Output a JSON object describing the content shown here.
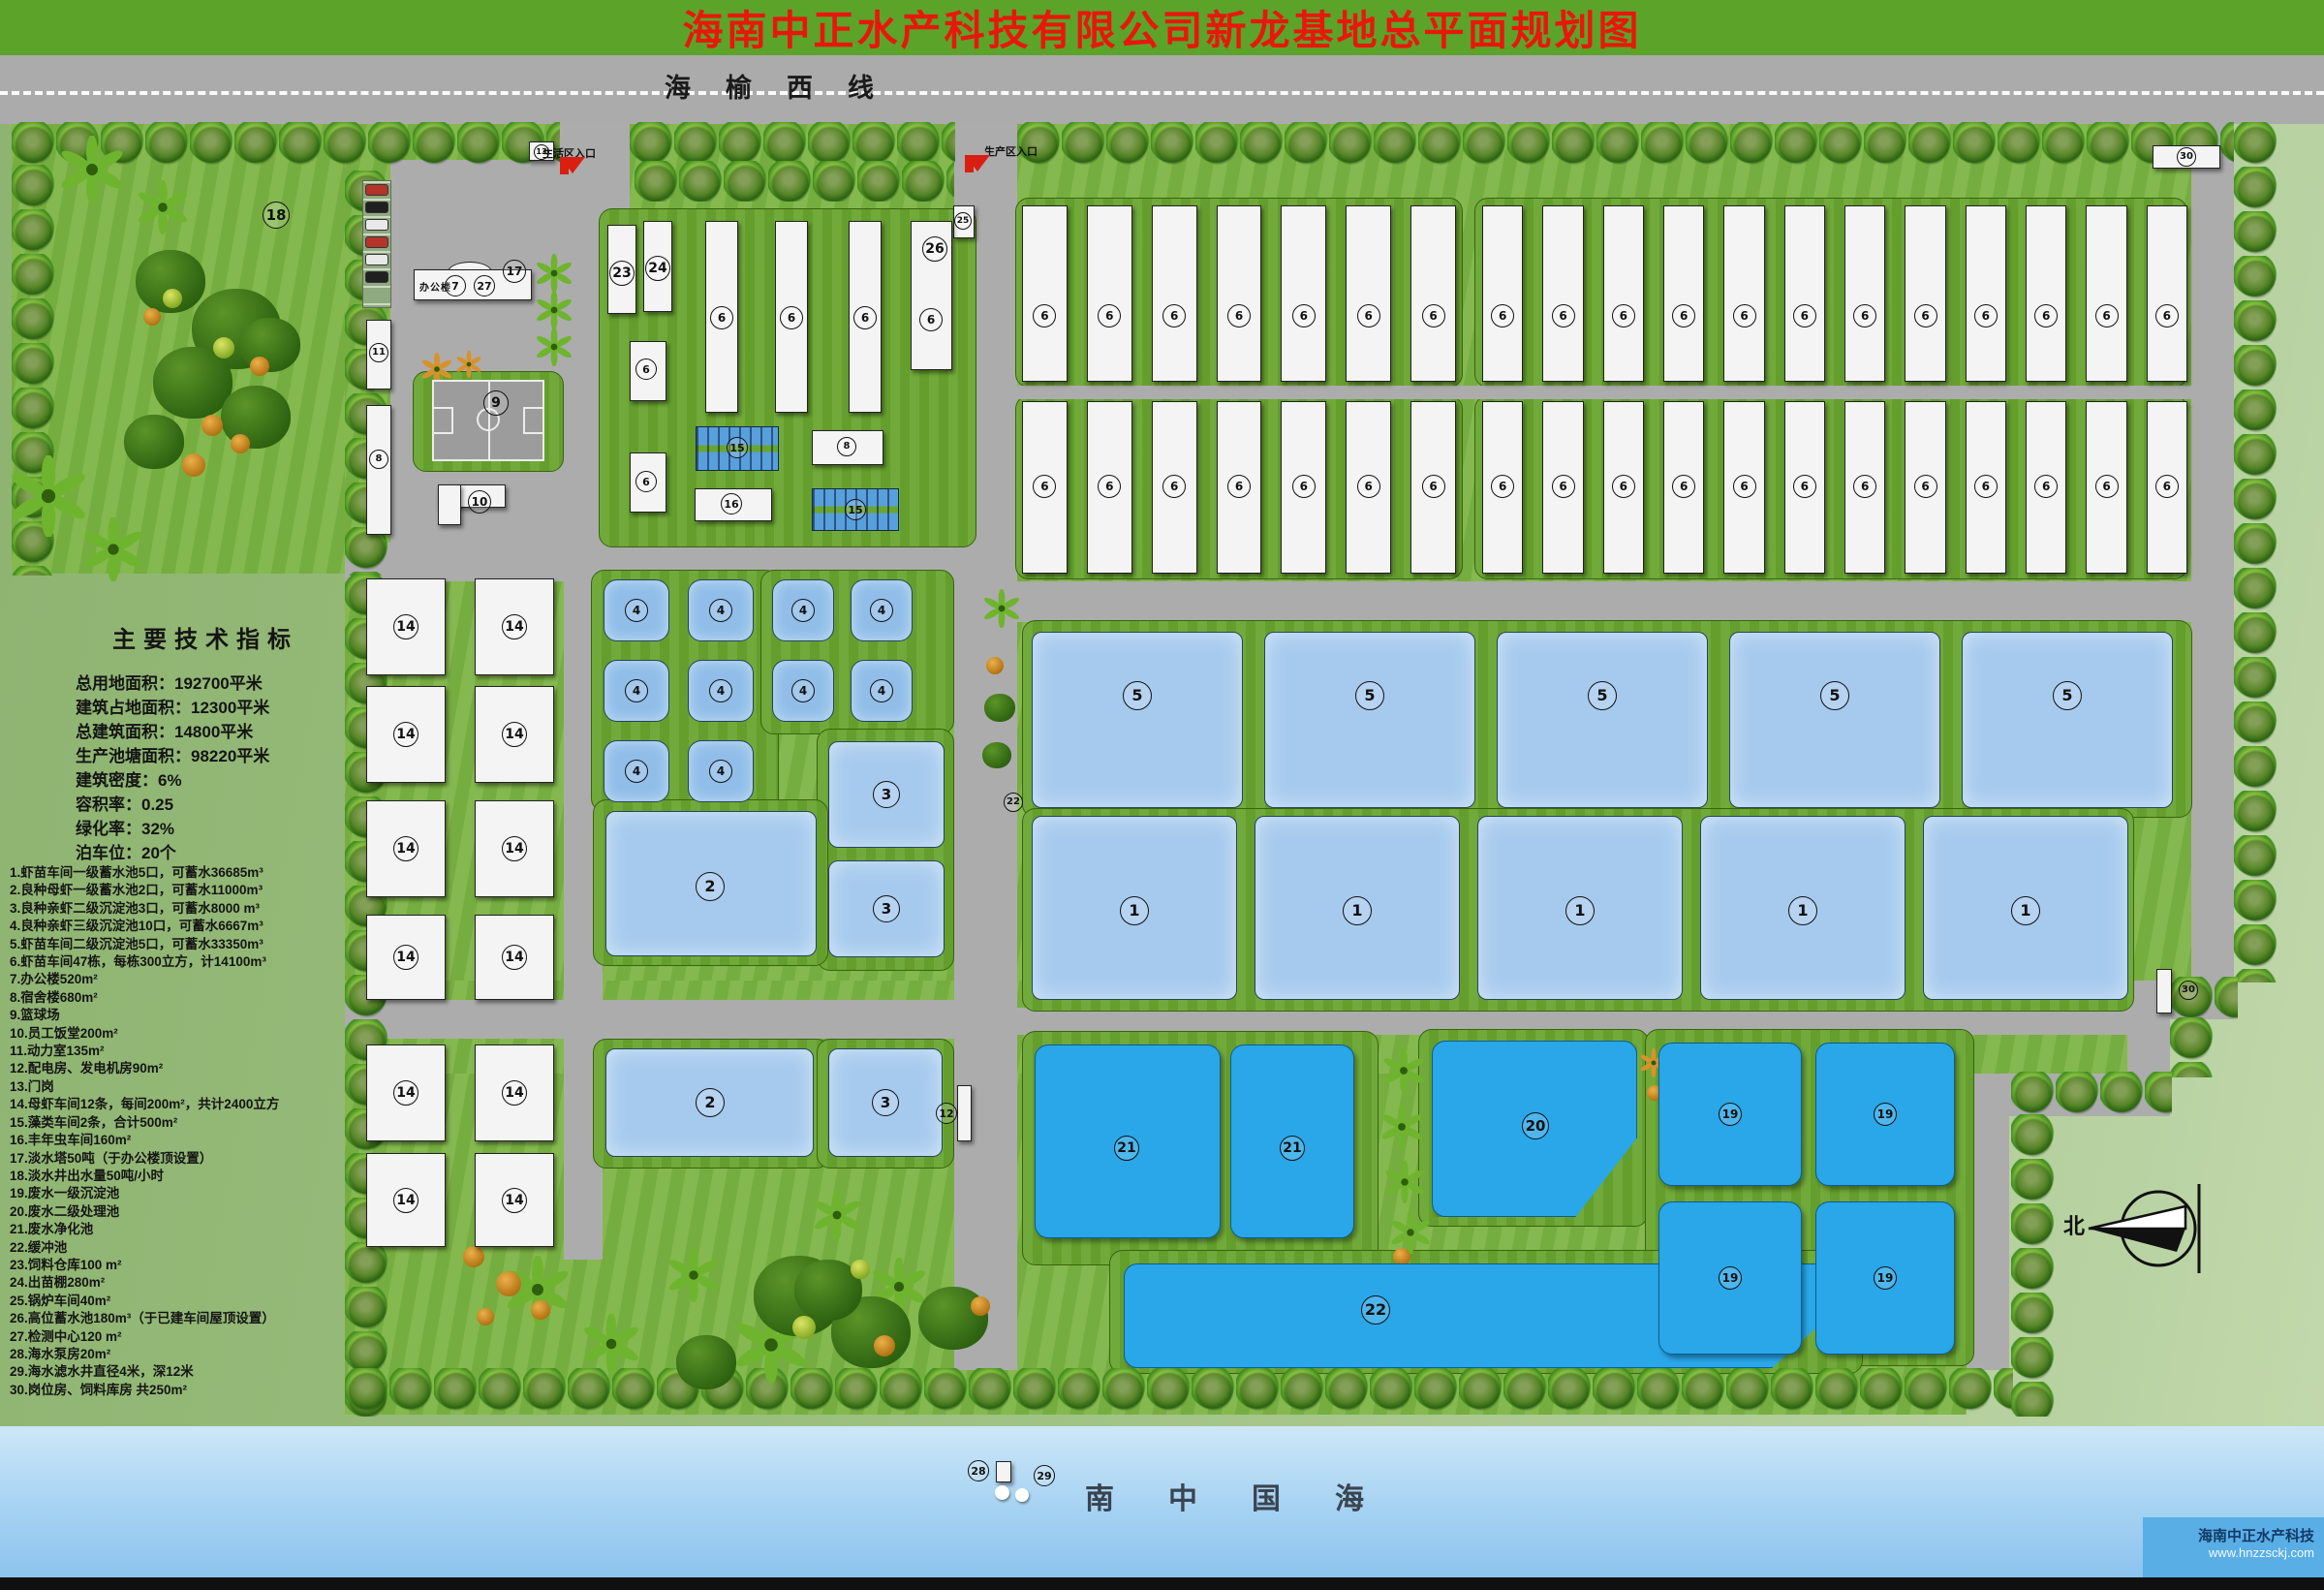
{
  "header": {
    "title": "海南中正水产科技有限公司新龙基地总平面规划图"
  },
  "highway": {
    "name": "海榆西线",
    "left_entrance": "生活区入口",
    "right_entrance": "生产区入口"
  },
  "indicators": {
    "title": "主要技术指标",
    "lines": [
      "总用地面积：192700平米",
      "建筑占地面积：12300平米",
      "总建筑面积：14800平米",
      "生产池塘面积：98220平米",
      "建筑密度：6%",
      "容积率：0.25",
      "绿化率：32%",
      "泊车位：20个"
    ]
  },
  "legend": {
    "items": [
      "1.虾苗车间一级蓄水池5口，可蓄水36685m³",
      "2.良种母虾一级蓄水池2口，可蓄水11000m³",
      "3.良种亲虾二级沉淀池3口，可蓄水8000 m³",
      "4.良种亲虾三级沉淀池10口，可蓄水6667m³",
      "5.虾苗车间二级沉淀池5口，可蓄水33350m³",
      "6.虾苗车间47栋，每栋300立方，计14100m³",
      "7.办公楼520m²",
      "8.宿舍楼680m²",
      "9.篮球场",
      "10.员工饭堂200m²",
      "11.动力室135m²",
      "12.配电房、发电机房90m²",
      "13.门岗",
      "14.母虾车间12条，每间200m²，共计2400立方",
      "15.藻类车间2条，合计500m²",
      "16.丰年虫车间160m²",
      "17.淡水塔50吨（于办公楼顶设置）",
      "18.淡水井出水量50吨/小时",
      "19.废水一级沉淀池",
      "20.废水二级处理池",
      "21.废水净化池",
      "22.缓冲池",
      "23.饲料仓库100 m²",
      "24.出苗棚280m²",
      "25.锅炉车间40m²",
      "26.高位蓄水池180m³（于已建车间屋顶设置）",
      "27.检测中心120 m²",
      "28.海水泵房20m²",
      "29.海水滤水井直径4米，深12米",
      "30.岗位房、饲料库房 共250m²"
    ]
  },
  "sea": {
    "title": "南中国海",
    "brand": "海南中正水产科技",
    "url": "www.hnzzsckj.com"
  },
  "compass": {
    "north": "北"
  },
  "office": {
    "label": "办公楼"
  },
  "plan": {
    "workshop_label": "6",
    "greens": [
      [
        12,
        95,
        390,
        497
      ],
      [
        356,
        95,
        1950,
        917
      ],
      [
        356,
        1012,
        1840,
        96
      ],
      [
        356,
        1108,
        1674,
        352
      ]
    ],
    "roads": [
      [
        578,
        95,
        72,
        467
      ],
      [
        985,
        95,
        65,
        1319
      ],
      [
        356,
        560,
        629,
        40
      ],
      [
        1050,
        600,
        1212,
        42
      ],
      [
        356,
        1032,
        629,
        40
      ],
      [
        1050,
        1040,
        1152,
        28
      ],
      [
        582,
        560,
        40,
        740
      ],
      [
        2262,
        95,
        44,
        957
      ],
      [
        2196,
        1012,
        66,
        40
      ],
      [
        2196,
        1052,
        44,
        56
      ],
      [
        2030,
        1108,
        210,
        44
      ],
      [
        2030,
        1152,
        44,
        262
      ],
      [
        403,
        165,
        177,
        400
      ]
    ],
    "roads_top": [
      [
        1050,
        398,
        1212,
        14
      ]
    ],
    "pads": [
      [
        618,
        215,
        390,
        350
      ],
      [
        1048,
        204,
        462,
        196
      ],
      [
        1522,
        204,
        736,
        196
      ],
      [
        1048,
        408,
        462,
        190
      ],
      [
        1522,
        408,
        736,
        190
      ],
      [
        610,
        588,
        194,
        250
      ],
      [
        785,
        588,
        200,
        170
      ],
      [
        843,
        752,
        142,
        250
      ],
      [
        612,
        825,
        243,
        172
      ],
      [
        612,
        1072,
        245,
        134
      ],
      [
        843,
        1072,
        142,
        134
      ],
      [
        1055,
        640,
        1208,
        204
      ],
      [
        1055,
        834,
        1148,
        210
      ],
      [
        1055,
        1064,
        368,
        242
      ],
      [
        1464,
        1062,
        238,
        204
      ],
      [
        1698,
        1062,
        340,
        348
      ],
      [
        1145,
        1290,
        778,
        128
      ],
      [
        426,
        383,
        156,
        104
      ]
    ],
    "treerows": [
      [
        12,
        126,
        566,
        46
      ],
      [
        650,
        126,
        336,
        46
      ],
      [
        1050,
        126,
        1256,
        46
      ],
      [
        655,
        166,
        330,
        42
      ],
      [
        12,
        170,
        46,
        424
      ],
      [
        356,
        176,
        46,
        418
      ],
      [
        356,
        592,
        46,
        870
      ],
      [
        356,
        1412,
        1722,
        48
      ],
      [
        2306,
        126,
        46,
        888
      ],
      [
        2240,
        1008,
        70,
        44
      ],
      [
        2240,
        1050,
        46,
        62
      ],
      [
        2076,
        1106,
        166,
        44
      ],
      [
        2076,
        1150,
        46,
        312
      ]
    ],
    "buildings": [
      [
        427,
        278,
        122,
        32
      ],
      [
        378,
        330,
        26,
        72
      ],
      [
        378,
        418,
        26,
        134
      ],
      [
        452,
        500,
        70,
        24
      ],
      [
        452,
        500,
        24,
        42
      ],
      [
        546,
        146,
        26,
        20
      ],
      [
        627,
        232,
        30,
        92
      ],
      [
        664,
        228,
        30,
        94
      ],
      [
        984,
        212,
        22,
        34
      ],
      [
        650,
        352,
        38,
        62
      ],
      [
        650,
        467,
        38,
        62
      ],
      [
        728,
        228,
        34,
        198
      ],
      [
        800,
        228,
        34,
        198
      ],
      [
        876,
        228,
        34,
        198
      ],
      [
        940,
        228,
        43,
        154
      ],
      [
        717,
        504,
        80,
        34
      ],
      [
        838,
        444,
        74,
        36
      ],
      [
        988,
        1120,
        15,
        58
      ],
      [
        2222,
        150,
        70,
        24
      ],
      [
        2226,
        1000,
        16,
        46
      ],
      [
        1028,
        1508,
        16,
        22
      ]
    ],
    "ponds_light": [
      [
        625,
        837,
        218,
        150
      ],
      [
        625,
        1082,
        215,
        112
      ],
      [
        855,
        765,
        120,
        110
      ],
      [
        855,
        888,
        120,
        100
      ],
      [
        855,
        1082,
        118,
        112
      ]
    ],
    "ponds_vivid": [
      {
        "r": [
          1068,
          1078,
          192,
          200
        ]
      },
      {
        "r": [
          1270,
          1078,
          128,
          200
        ]
      },
      {
        "r": [
          1478,
          1074,
          212,
          182
        ],
        "c": "polygon(0 0,100% 0,100% 55%,70% 100%,0 100%)"
      },
      {
        "r": [
          1160,
          1304,
          752,
          108
        ],
        "c": "polygon(0 0,97% 0,100% 30%,89% 100%,0 100%)"
      }
    ],
    "strips15": [
      [
        718,
        440,
        86,
        46
      ],
      [
        838,
        504,
        90,
        44
      ]
    ],
    "workshop_rows": [
      [
        1055,
        212,
        448,
        182,
        7,
        326
      ],
      [
        1530,
        212,
        728,
        182,
        12,
        326
      ],
      [
        1055,
        414,
        448,
        178,
        7,
        502
      ],
      [
        1530,
        414,
        728,
        178,
        12,
        502
      ]
    ],
    "pond_rows": [
      [
        1065,
        652,
        218,
        182,
        5,
        22,
        718,
        30,
        "5"
      ],
      [
        1065,
        842,
        212,
        190,
        5,
        18,
        940,
        30,
        "1"
      ]
    ],
    "pond_grids": [
      {
        "label": "4",
        "cls": "pond4",
        "cols": [
          [
            623,
            68
          ],
          [
            710,
            68
          ]
        ],
        "rows": [
          [
            598,
            64
          ],
          [
            681,
            64
          ],
          [
            764,
            64
          ]
        ],
        "d": 24
      },
      {
        "label": "4",
        "cls": "pond4",
        "cols": [
          [
            797,
            64
          ],
          [
            878,
            64
          ]
        ],
        "rows": [
          [
            598,
            64
          ],
          [
            681,
            64
          ]
        ],
        "d": 24
      },
      {
        "label": "19",
        "cls": "pondv",
        "cols": [
          [
            1712,
            148
          ],
          [
            1874,
            144
          ]
        ],
        "rows": [
          [
            1076,
            148
          ],
          [
            1240,
            158
          ]
        ],
        "d": 24
      }
    ],
    "b14": {
      "label": "14",
      "cols": [
        378,
        490
      ],
      "w": 82,
      "d": 26,
      "rows": [
        [
          597,
          100
        ],
        [
          708,
          100
        ],
        [
          826,
          100
        ],
        [
          944,
          88
        ],
        [
          1078,
          100
        ],
        [
          1190,
          97
        ]
      ]
    },
    "markers": [
      [
        "18",
        285,
        222,
        28
      ],
      [
        "13",
        559,
        157,
        16
      ],
      [
        "7",
        470,
        295,
        22
      ],
      [
        "27",
        500,
        295,
        22
      ],
      [
        "17",
        531,
        280,
        24
      ],
      [
        "9",
        512,
        416,
        26
      ],
      [
        "11",
        391,
        364,
        20
      ],
      [
        "8",
        391,
        474,
        20
      ],
      [
        "10",
        495,
        518,
        24
      ],
      [
        "23",
        642,
        282,
        26
      ],
      [
        "24",
        679,
        277,
        26
      ],
      [
        "25",
        994,
        228,
        18
      ],
      [
        "26",
        965,
        257,
        26
      ],
      [
        "6",
        745,
        328,
        24
      ],
      [
        "6",
        817,
        328,
        24
      ],
      [
        "6",
        893,
        328,
        24
      ],
      [
        "6",
        961,
        330,
        24
      ],
      [
        "6",
        667,
        381,
        22
      ],
      [
        "6",
        667,
        497,
        22
      ],
      [
        "15",
        761,
        462,
        22
      ],
      [
        "15",
        883,
        526,
        22
      ],
      [
        "16",
        755,
        520,
        22
      ],
      [
        "8",
        874,
        461,
        20
      ],
      [
        "2",
        733,
        915,
        30
      ],
      [
        "2",
        733,
        1138,
        30
      ],
      [
        "3",
        915,
        820,
        28
      ],
      [
        "3",
        915,
        938,
        28
      ],
      [
        "3",
        914,
        1138,
        28
      ],
      [
        "12",
        977,
        1149,
        22
      ],
      [
        "22",
        1046,
        828,
        20
      ],
      [
        "21",
        1163,
        1185,
        26
      ],
      [
        "21",
        1334,
        1185,
        26
      ],
      [
        "20",
        1585,
        1162,
        28
      ],
      [
        "22",
        1420,
        1352,
        30
      ],
      [
        "30",
        2257,
        162,
        20
      ],
      [
        "30",
        2259,
        1022,
        20
      ],
      [
        "28",
        1010,
        1518,
        22
      ],
      [
        "29",
        1078,
        1523,
        22
      ]
    ],
    "cars": [
      [
        377,
        190,
        "#b5342a"
      ],
      [
        377,
        208,
        "#202020"
      ],
      [
        377,
        226,
        "#e9e9e9"
      ],
      [
        377,
        244,
        "#b5342a"
      ],
      [
        377,
        262,
        "#e9e9e9"
      ],
      [
        377,
        280,
        "#202020"
      ]
    ],
    "sea_dots": [
      [
        1027,
        1533,
        15
      ],
      [
        1048,
        1536,
        14
      ]
    ]
  }
}
